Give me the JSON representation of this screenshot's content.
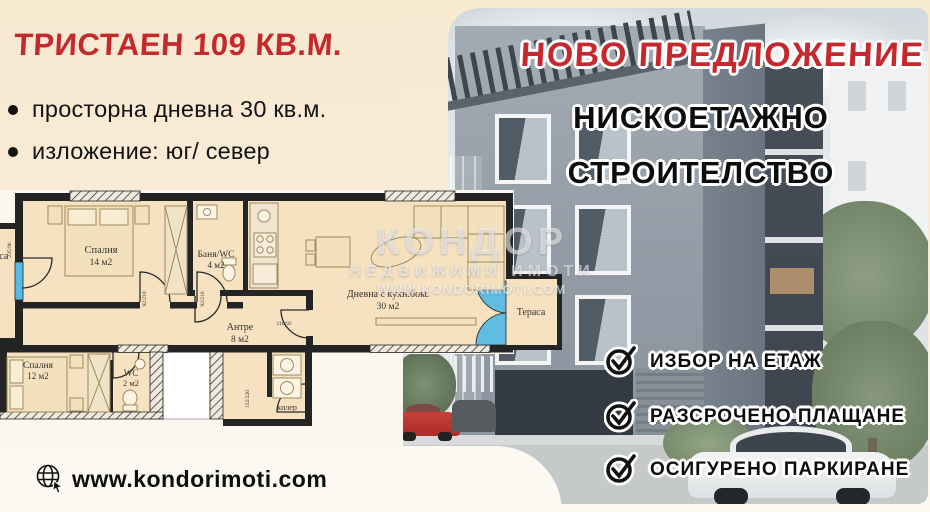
{
  "left_panel": {
    "title": "ТРИСТАЕН 109 КВ.М.",
    "bullets": [
      "просторна дневна 30 кв.м.",
      "изложение: юг/ север"
    ],
    "website": "www.kondorimoti.com"
  },
  "right_panel": {
    "headline": "НОВО ПРЕДЛОЖЕНИЕ",
    "subheadline": [
      "НИСКОЕТАЖНО",
      "СТРОИТЕЛСТВО"
    ],
    "features": [
      "ИЗБОР НА ЕТАЖ",
      "РАЗСРОЧЕНО ПЛАЩАНЕ",
      "ОСИГУРЕНО ПАРКИРАНЕ"
    ]
  },
  "floor_plan": {
    "rooms": {
      "bedroom1": {
        "name": "Спалня",
        "area": "14 м2"
      },
      "bath": {
        "name": "Баня/WC",
        "area": "4 м2"
      },
      "living": {
        "name": "Дневна с кухн.бокс",
        "area": "30 м2"
      },
      "hall": {
        "name": "Антре",
        "area": "8 м2"
      },
      "bedroom2": {
        "name": "Спалня",
        "area": "12 м2"
      },
      "wc": {
        "name": "WC",
        "area": "2 м2"
      },
      "closet": {
        "name": "килер"
      },
      "terrace": {
        "name": "Тераса"
      },
      "terrace_left": {
        "name": "Тераса"
      }
    },
    "dims": {
      "d1": "92/210",
      "d2": "92/210",
      "d3": "210/92",
      "d4": "152/220",
      "d5": "235/96"
    }
  },
  "watermark": {
    "brand": "КОНДОР",
    "line2": "НЕДВИЖИМИ ИМОТИ",
    "line3": "WWW.KONDORIMOTI.COM"
  },
  "colors": {
    "accent_red": "#c5282d",
    "cream_bg": "#f8e9d2",
    "text_black": "#121212",
    "plan_room_fill": "#f6e2c0",
    "plan_glass_blue": "#54bce9"
  }
}
